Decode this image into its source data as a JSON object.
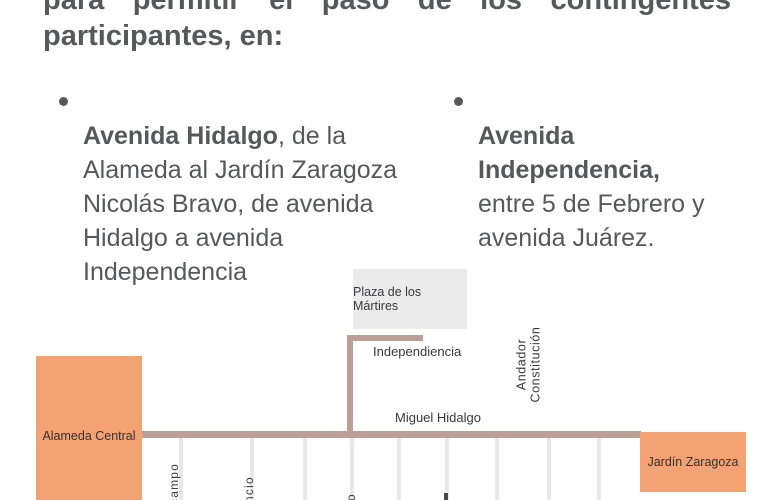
{
  "header": {
    "line1_words": [
      "para",
      "permitir",
      "el",
      "paso",
      "de",
      "los",
      "contingentes"
    ],
    "line2": "participantes, en:"
  },
  "bullets": {
    "left": {
      "bold": "Avenida Hidalgo",
      "rest": ", de la\nAlameda al Jardín Zaragoza\nNicolás Bravo, de avenida\nHidalgo a avenida\nIndependencia"
    },
    "right": {
      "bold": "Avenida\nIndependencia,",
      "rest": "\nentre 5 de Febrero y\navenida Juárez."
    }
  },
  "map": {
    "colors": {
      "park_orange": "#F2A273",
      "closed_road_tan": "#BCA096",
      "cross_street_gray": "#E8E8E8",
      "plaza_gray": "#EBEBEC",
      "label_text": "#3A3A3C"
    },
    "plaza_label": "Plaza de los Mártires",
    "street_vertical_label": "Independiencia",
    "street_horizontal_label": "Miguel Hidalgo",
    "andador_label": "Andador Constitución",
    "park_left_label": "Alameda Central",
    "park_right_label": "Jardín Zaragoza",
    "street_fragments": [
      "campo",
      "ncio",
      "o"
    ]
  }
}
